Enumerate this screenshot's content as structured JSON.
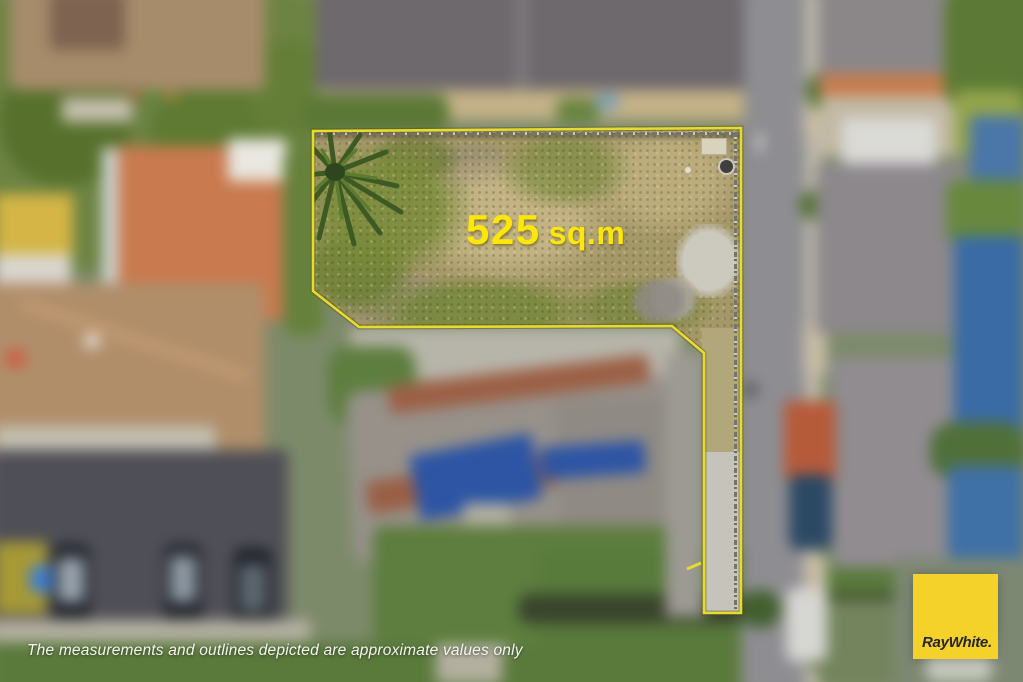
{
  "lot": {
    "area_value": "525",
    "area_unit": "sq.m",
    "area_label_full": "525 sq.m"
  },
  "disclaimer": {
    "text": "The measurements and outlines depicted are approximate values only"
  },
  "brand": {
    "logo_text": "RayWhite."
  },
  "colors": {
    "outline-yellow": "#e6dc2f",
    "label-yellow": "#fde60a",
    "logo-bg": "#f4d229",
    "logo-text": "#27252f"
  }
}
